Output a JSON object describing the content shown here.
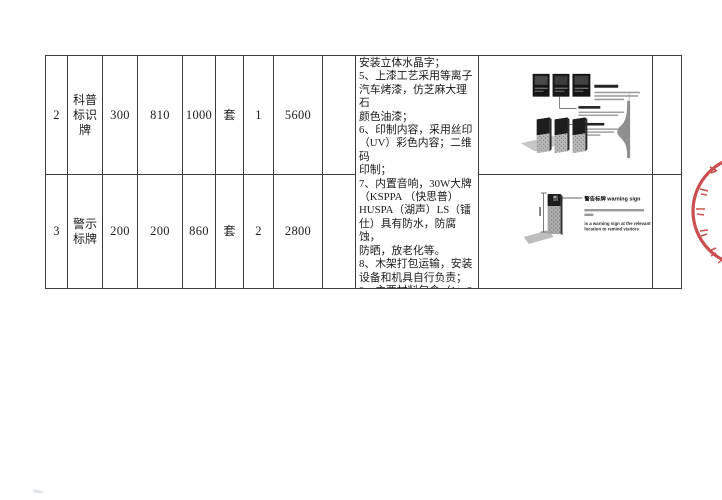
{
  "document": {
    "background": "#ffffff",
    "table_border_color": "#3b3b3b",
    "text_color": "#1e1e1e"
  },
  "table": {
    "rows": [
      {
        "no": "2",
        "name": "科普标识牌",
        "dim1": "300",
        "dim2": "810",
        "dim3": "1000",
        "unit": "套",
        "qty": "1",
        "price": "5600"
      },
      {
        "no": "3",
        "name": "警示标牌",
        "dim1": "200",
        "dim2": "200",
        "dim3": "860",
        "unit": "套",
        "qty": "2",
        "price": "2800"
      }
    ],
    "remarks": "安装立体水晶字；\n5、上漆工艺采用等离子\n汽车烤漆，仿芝麻大理石\n颜色油漆；\n6、印制内容，采用丝印\n（UV）彩色内容；二维码\n印制；\n7、内置音响，30W大牌\n（KSPPA （快思普）\nHUSPA（湖声）LS（镭\n仕）具有防水，防腐蚀，\n防晒，放老化等。\n8、木架打包运输，安装\n设备和机具自行负责；\n9、主要材料包含（1、2\n、3）项；"
  },
  "figures": {
    "warning_sign": {
      "heading": "警告标牌 warning sign",
      "caption_line1": "is a warning sign at the relevant",
      "caption_line2": "location to remind visitors"
    }
  },
  "stamp": {
    "color": "#c43131"
  }
}
